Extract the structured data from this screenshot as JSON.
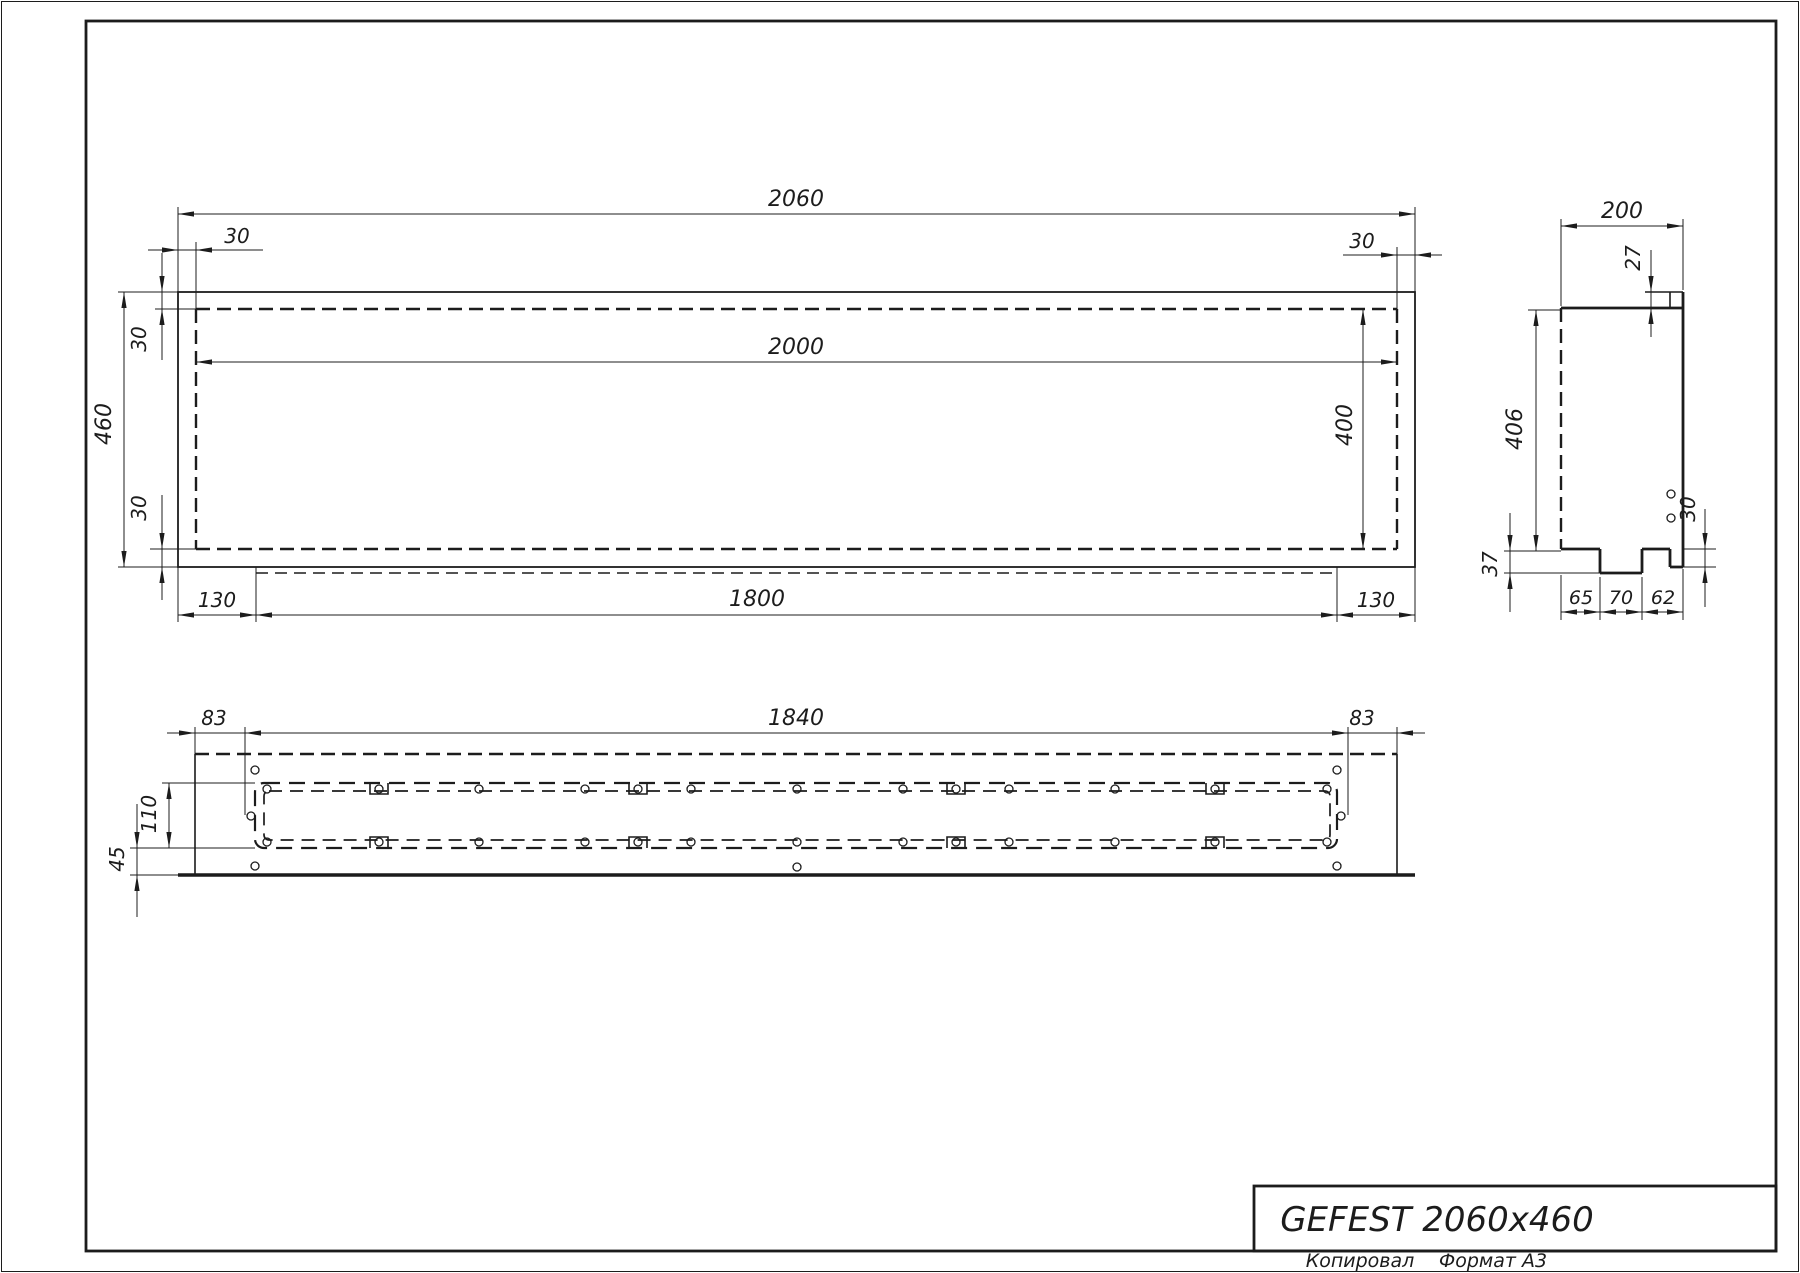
{
  "colors": {
    "ink": "#1c1c1c",
    "paper": "#ffffff"
  },
  "title_block": {
    "title": "GEFEST 2060x460",
    "copied_label": "Копировал",
    "format_label": "Формат А3"
  },
  "front_view": {
    "dim_total_width": "2060",
    "dim_inner_width": "2000",
    "dim_inset_top_left": "30",
    "dim_inset_top_right": "30",
    "dim_wall_top": "30",
    "dim_wall_bottom": "30",
    "dim_total_height": "460",
    "dim_inner_height": "400",
    "dim_foot_left": "130",
    "dim_foot_length": "1800",
    "dim_foot_right": "130"
  },
  "side_view": {
    "dim_depth": "200",
    "dim_lip": "27",
    "dim_inner_height": "406",
    "dim_foot_height": "37",
    "dim_back_lip": "30",
    "dim_seg_left": "65",
    "dim_seg_mid": "70",
    "dim_seg_right": "62"
  },
  "bottom_view": {
    "dim_margin_left": "83",
    "dim_length": "1840",
    "dim_margin_right": "83",
    "dim_trough_width": "110",
    "dim_edge_offset": "45"
  }
}
